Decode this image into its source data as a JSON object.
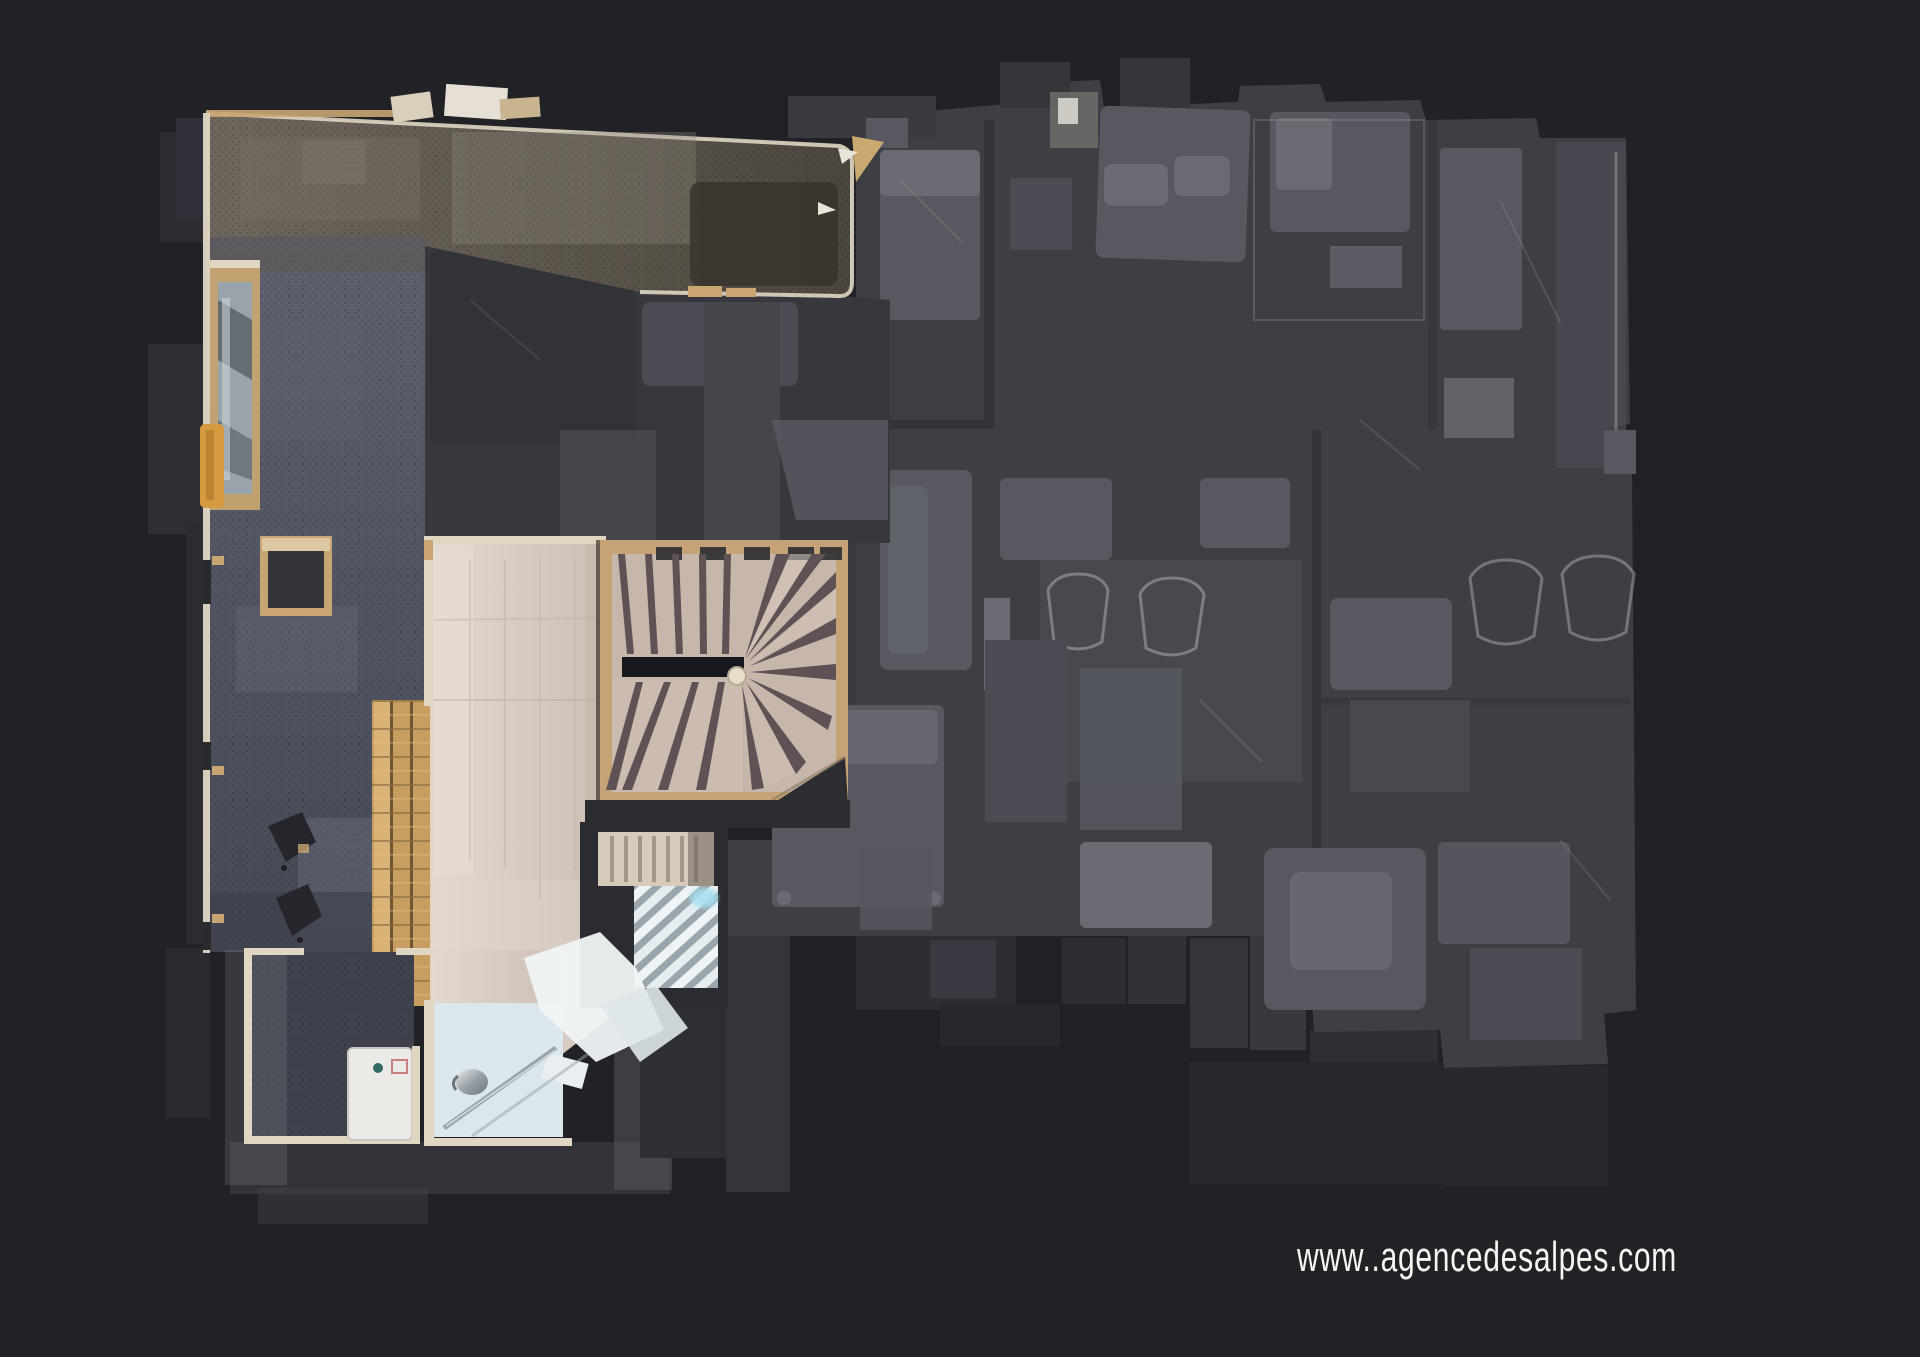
{
  "watermark": {
    "text": "www..agencedesalpes.com"
  },
  "floorplan": {
    "active_floor_label": "textured-floor-left",
    "ghost_floor_label": "faded-floor-right"
  },
  "palette": {
    "background": "#212226",
    "ghost_base": "#3e3f44",
    "ghost_room_dark": "#37383d",
    "ghost_furniture_1": "#4b4c53",
    "ghost_furniture_2": "#575860",
    "ghost_furniture_3": "#6a6b72",
    "ghost_wisp": "#a9aab0",
    "ghost_lower": "#2b2c30",
    "wall_cream": "#e0d6c2",
    "wall_wood": "#c8a572",
    "carpet_bottom": "#3f424c",
    "stair_frame": "#c5a377",
    "stair_tread": "#c7b6aa",
    "stair_separator": "#5e5254",
    "stair_void": "#17181b",
    "bath_floor": "#dce7ed",
    "bath_white": "#f0f4f6",
    "chrome": "#9aa4ab",
    "bench_wood": "#c89e60",
    "bench_gap": "#6f5632",
    "amber": "#d69a40",
    "glow_cyan": "#a5e0f2",
    "watermark_color": "#f5f5f3"
  }
}
